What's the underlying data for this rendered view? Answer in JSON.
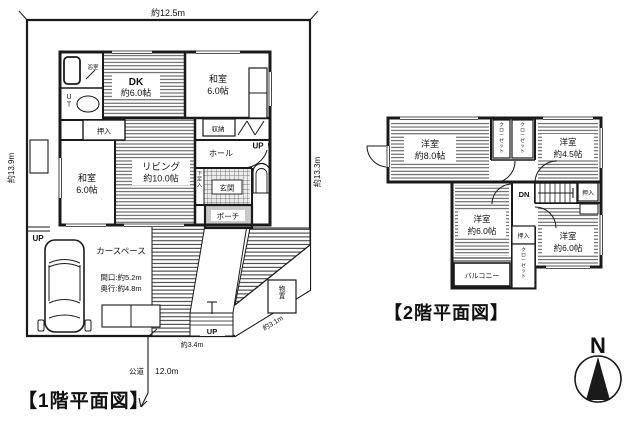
{
  "floor1": {
    "title": "【1階平面図】",
    "dims": {
      "width_top": "約12.5m",
      "height_left": "約13.9m",
      "height_right": "約13.3m",
      "steps_width": "約3.4m",
      "slope_width": "約3.1m",
      "road_name": "公道",
      "road_length": "12.0m",
      "frontage": "間口:約5.2m",
      "depth": "奥行:約4.8m"
    },
    "rooms": {
      "bath": "浴室",
      "utility": "UT",
      "dk": "DK",
      "dk_size": "約6.0帖",
      "washitsu_top": "和室",
      "washitsu_top_size": "6.0帖",
      "closet": "押入",
      "washitsu_left": "和室",
      "washitsu_left_size": "6.0帖",
      "living": "リビング",
      "living_size": "約10.0帖",
      "storage": "収納",
      "hall": "ホール",
      "shoe_cabinet": "下足入",
      "entrance": "玄関",
      "porch": "ポーチ",
      "shed": "物置",
      "car_space": "カースペース"
    },
    "stairs": {
      "up_main": "UP",
      "up_site": "UP",
      "up_steps": "UP"
    }
  },
  "floor2": {
    "title": "【2階平面図】",
    "rooms": {
      "room_8": "洋室",
      "room_8_size": "約8.0帖",
      "closet_a": "クローゼット",
      "closet_b": "クローゼット",
      "room_45": "洋室",
      "room_45_size": "約4.5帖",
      "oshiire_right": "押入",
      "room_6m": "洋室",
      "room_6m_size": "約6.0帖",
      "oshiire_mid": "押入",
      "closet_c": "クローゼット",
      "room_6r": "洋室",
      "room_6r_size": "約6.0帖",
      "balcony": "バルコニー"
    },
    "stairs": {
      "dn": "DN"
    }
  },
  "compass": {
    "north": "N"
  }
}
